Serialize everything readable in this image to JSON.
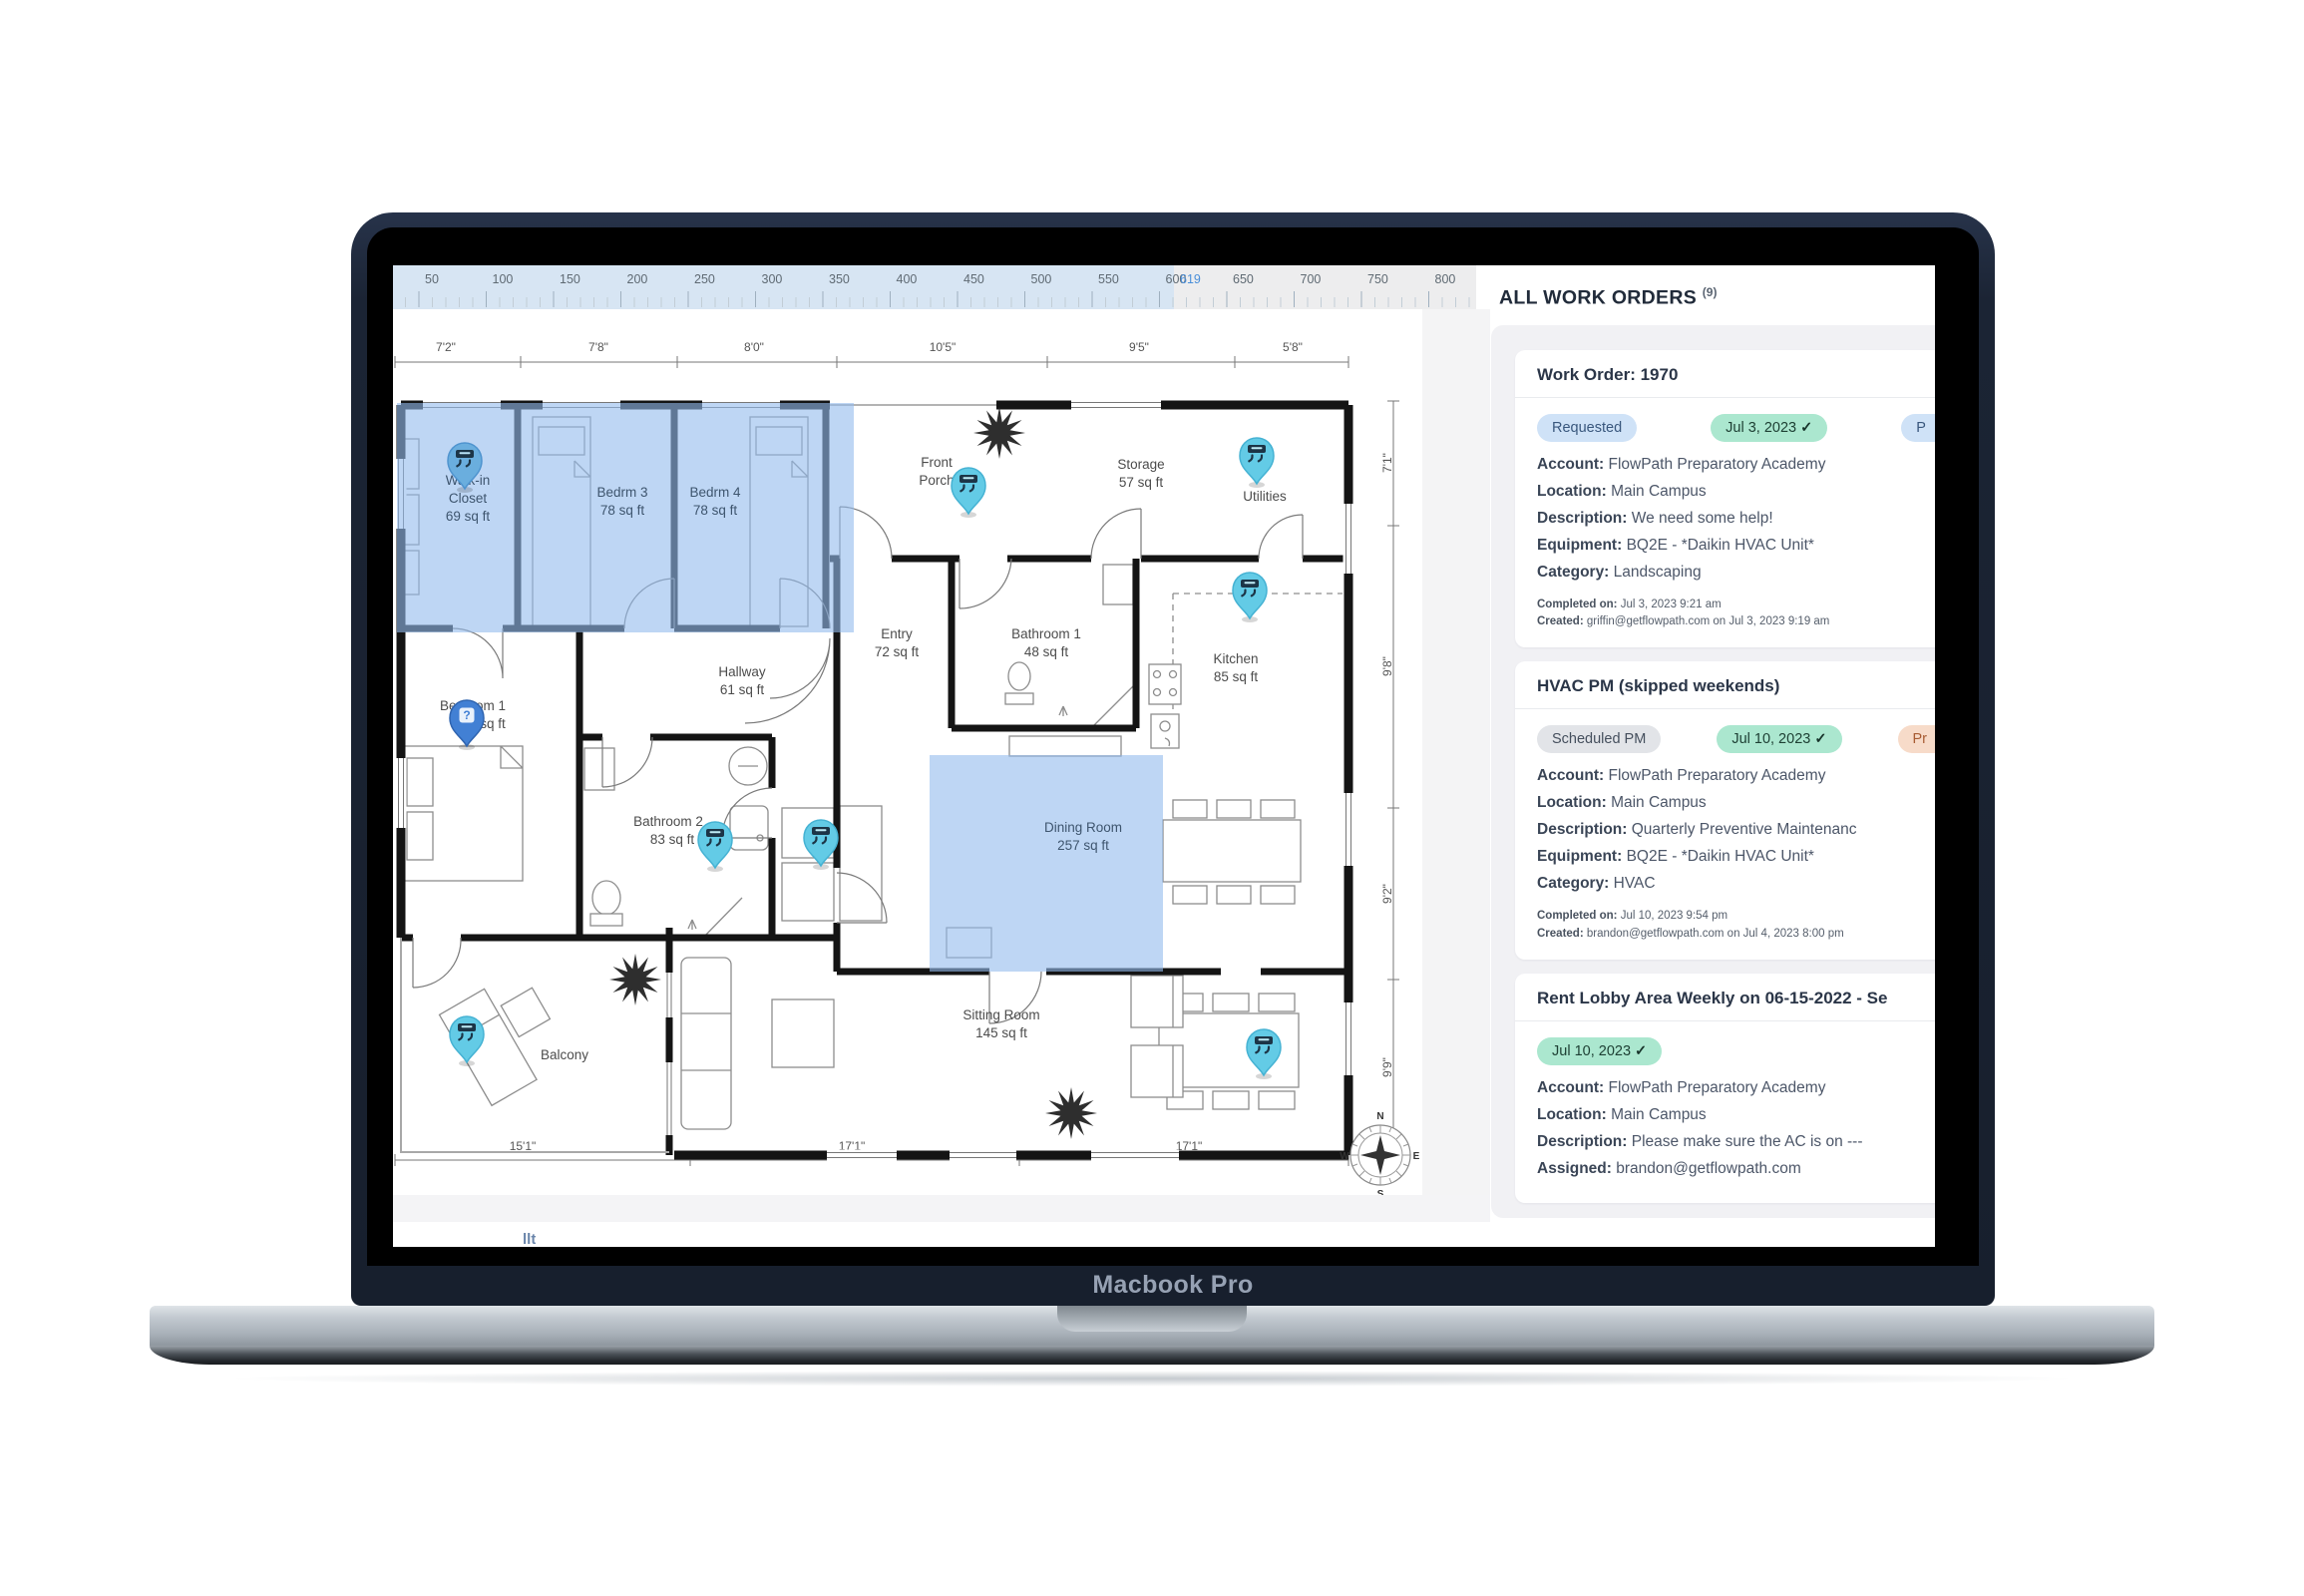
{
  "icons": {
    "check": "✓",
    "question": "?"
  },
  "device": {
    "brand": "Macbook Pro"
  },
  "app": {
    "ruler": {
      "labels": [
        "50",
        "100",
        "150",
        "200",
        "250",
        "300",
        "350",
        "400",
        "450",
        "500",
        "550",
        "600",
        "650",
        "700",
        "750",
        "800"
      ],
      "cursor_label": "619"
    },
    "floor_plan": {
      "dimensions_top": [
        "7'2\"",
        "7'8\"",
        "8'0\"",
        "10'5\"",
        "9'5\"",
        "5'8\""
      ],
      "dimensions_right": [
        "7'1\"",
        "9'8\"",
        "9'2\"",
        "9'9\""
      ],
      "dimensions_bottom": [
        "15'1\"",
        "17'1\"",
        "17'1\""
      ],
      "compass": {
        "n": "N",
        "e": "E",
        "s": "S",
        "w": "W"
      },
      "rooms": {
        "walk_in_closet": {
          "name": "Walk-in",
          "name2": "Closet",
          "area": "69 sq ft"
        },
        "bedrm3": {
          "name": "Bedrm 3",
          "area": "78 sq ft"
        },
        "bedrm4": {
          "name": "Bedrm 4",
          "area": "78 sq ft"
        },
        "front_porch": {
          "name": "Front",
          "name2": "Porch"
        },
        "storage": {
          "name": "Storage",
          "area": "57 sq ft"
        },
        "utilities": {
          "name": "Utilities"
        },
        "entry": {
          "name": "Entry",
          "area": "72 sq ft"
        },
        "bathroom1": {
          "name": "Bathroom 1",
          "area": "48 sq ft"
        },
        "kitchen": {
          "name": "Kitchen",
          "area": "85 sq ft"
        },
        "bedroom1": {
          "name": "Bedroom 1",
          "area": "sq ft"
        },
        "hallway": {
          "name": "Hallway",
          "area": "61 sq ft"
        },
        "bathroom2": {
          "name": "Bathroom 2",
          "area": "83 sq ft"
        },
        "dining_room": {
          "name": "Dining Room",
          "area": "257 sq ft"
        },
        "sitting_room": {
          "name": "Sitting Room",
          "area": "145 sq ft"
        },
        "balcony": {
          "name": "Balcony"
        }
      }
    },
    "panel": {
      "title": "ALL WORK ORDERS",
      "count": "(9)",
      "cards": [
        {
          "title": "Work Order: 1970",
          "badges": [
            {
              "label": "Requested"
            },
            {
              "label": "Jul 3, 2023"
            },
            {
              "label": "P"
            }
          ],
          "fields": [
            {
              "label": "Account:",
              "value": "FlowPath Preparatory Academy"
            },
            {
              "label": "Location:",
              "value": "Main Campus"
            },
            {
              "label": "Description:",
              "value": "We need some help!"
            },
            {
              "label": "Equipment:",
              "value": "BQ2E - *Daikin HVAC Unit*"
            },
            {
              "label": "Category:",
              "value": "Landscaping"
            }
          ],
          "footer": [
            {
              "label": "Completed on:",
              "value": "Jul 3, 2023 9:21 am"
            },
            {
              "label": "Created:",
              "value": "griffin@getflowpath.com on Jul 3, 2023 9:19 am"
            }
          ]
        },
        {
          "title": "HVAC PM (skipped weekends)",
          "badges": [
            {
              "label": "Scheduled PM"
            },
            {
              "label": "Jul 10, 2023"
            },
            {
              "label": "Pr"
            }
          ],
          "fields": [
            {
              "label": "Account:",
              "value": "FlowPath Preparatory Academy"
            },
            {
              "label": "Location:",
              "value": "Main Campus"
            },
            {
              "label": "Description:",
              "value": "Quarterly Preventive Maintenanc"
            },
            {
              "label": "Equipment:",
              "value": "BQ2E - *Daikin HVAC Unit*"
            },
            {
              "label": "Category:",
              "value": "HVAC"
            }
          ],
          "footer": [
            {
              "label": "Completed on:",
              "value": "Jul 10, 2023 9:54 pm"
            },
            {
              "label": "Created:",
              "value": "brandon@getflowpath.com on Jul 4, 2023 8:00 pm"
            }
          ]
        },
        {
          "title": "Rent Lobby Area Weekly on 06-15-2022 - Se",
          "badges": [
            {
              "label": "Jul 10, 2023"
            }
          ],
          "fields": [
            {
              "label": "Account:",
              "value": "FlowPath Preparatory Academy"
            },
            {
              "label": "Location:",
              "value": "Main Campus"
            },
            {
              "label": "Description:",
              "value": "Please make sure the AC is on ---"
            },
            {
              "label": "Assigned:",
              "value": "brandon@getflowpath.com"
            }
          ]
        }
      ]
    },
    "clipped_fragment": "llt"
  }
}
